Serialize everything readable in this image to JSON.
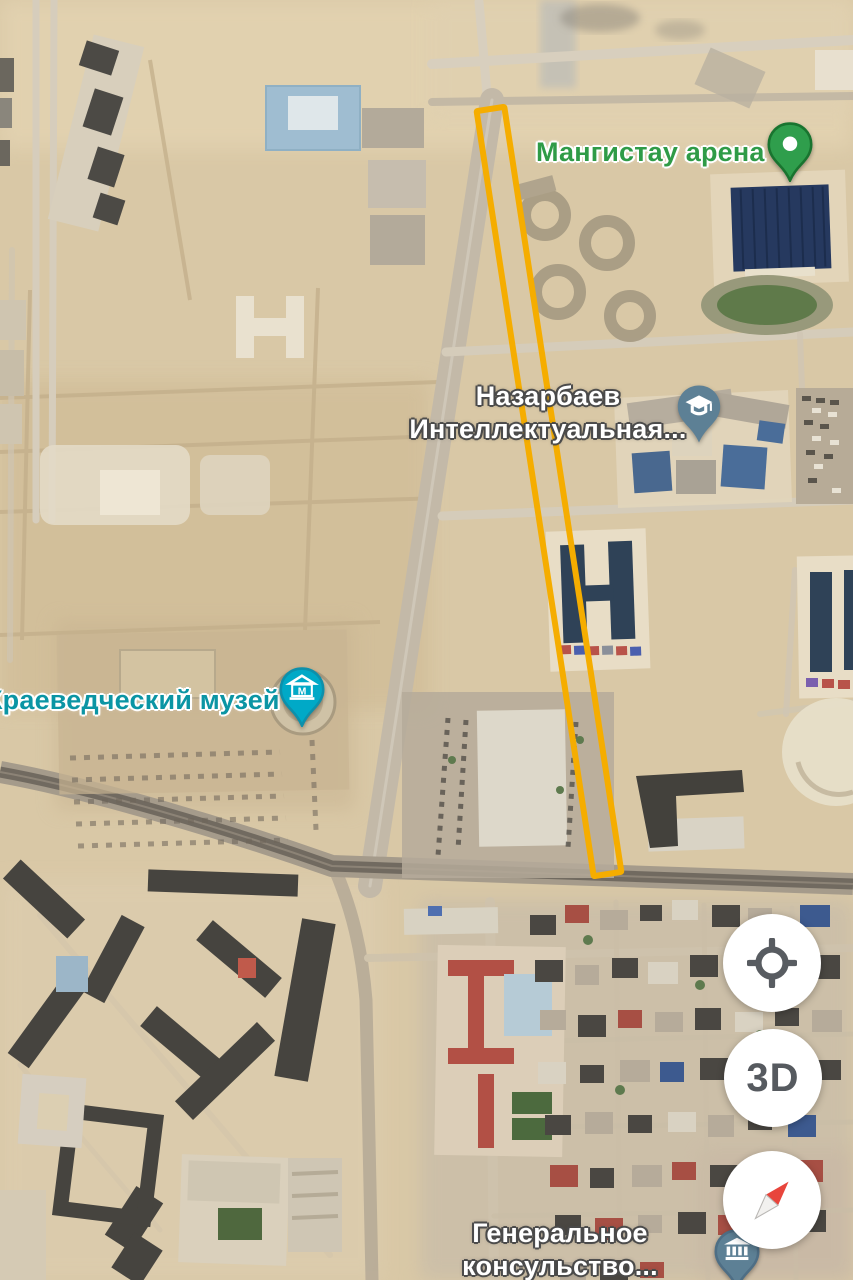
{
  "app": {
    "name": "maps-satellite-view"
  },
  "map": {
    "labels": {
      "arena": {
        "text": "Мангистау арена",
        "color": "#2f9b47"
      },
      "school": {
        "line1": "Назарбаев",
        "line2": "Интеллектуальная...",
        "color": "#ffffff"
      },
      "museum": {
        "text": "Краеведческий музей",
        "color": "#0b95a4"
      },
      "consulate": {
        "line1": "Генеральное",
        "line2": "консульство...",
        "color": "#ffffff"
      }
    },
    "pins": {
      "arena": {
        "kind": "place-pin",
        "color": "#2f9e4c"
      },
      "school": {
        "kind": "education-pin",
        "color": "#5d8095"
      },
      "museum": {
        "kind": "museum-pin",
        "color": "#00a9c7",
        "letter": "М"
      },
      "consulate": {
        "kind": "government-pin",
        "color": "#5d8095"
      }
    },
    "route_highlight": {
      "color": "#f5ad00"
    }
  },
  "controls": {
    "my_location": {
      "icon": "crosshair"
    },
    "three_d": {
      "label": "3D"
    },
    "compass": {
      "icon": "compass-needle"
    }
  }
}
